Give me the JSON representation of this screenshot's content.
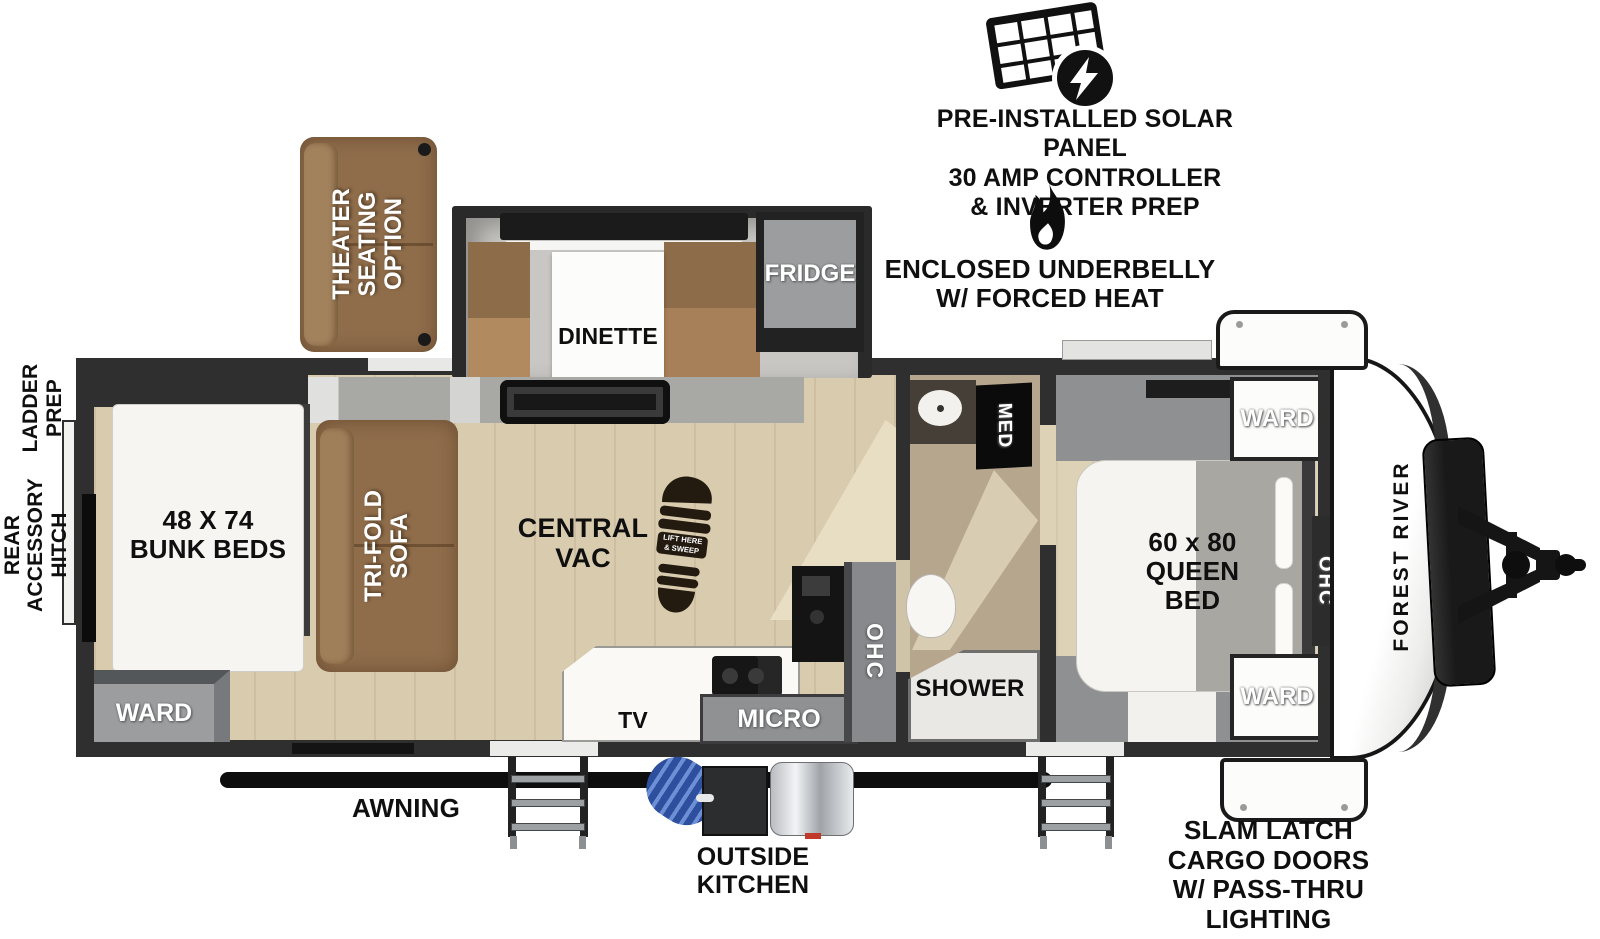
{
  "badges": {
    "solar": {
      "line1": "PRE-INSTALLED SOLAR PANEL",
      "line2": "30 AMP CONTROLLER",
      "line3": "& INVERTER PREP"
    },
    "heat": {
      "line1": "ENCLOSED UNDERBELLY",
      "line2": "W/ FORCED HEAT"
    }
  },
  "exterior": {
    "awning": "AWNING",
    "outside_kitchen_line1": "OUTSIDE",
    "outside_kitchen_line2": "KITCHEN",
    "cargo_line1": "SLAM LATCH",
    "cargo_line2": "CARGO DOORS",
    "cargo_line3": "W/ PASS-THRU",
    "cargo_line4": "LIGHTING",
    "ladder_line1": "LADDER",
    "ladder_line2": "PREP",
    "rear_hitch_line1": "REAR",
    "rear_hitch_line2": "ACCESSORY",
    "rear_hitch_line3": "HITCH",
    "brand": "FOREST RIVER"
  },
  "interior": {
    "theater_line1": "THEATER",
    "theater_line2": "SEATING",
    "theater_line3": "OPTION",
    "dinette": "DINETTE",
    "fridge": "FRIDGE",
    "bunks_line1": "48 X 74",
    "bunks_line2": "BUNK BEDS",
    "ward": "WARD",
    "trifold_line1": "TRI-FOLD",
    "trifold_line2": "SOFA",
    "central_vac_line1": "CENTRAL",
    "central_vac_line2": "VAC",
    "vac_pan_line1": "LIFT HERE",
    "vac_pan_line2": "& SWEEP",
    "tv": "TV",
    "micro": "MICRO",
    "ohc": "OHC",
    "med": "MED",
    "shower": "SHOWER",
    "queen_line1": "60 x 80",
    "queen_line2": "QUEEN",
    "queen_line3": "BED"
  },
  "colors": {
    "wall": "#2f2f2f",
    "floor": "#d9cbae",
    "sofa_brown": "#8f6d4b",
    "cabinet_gray": "#9b9d9f",
    "hose_blue": "#3a5fb0"
  }
}
